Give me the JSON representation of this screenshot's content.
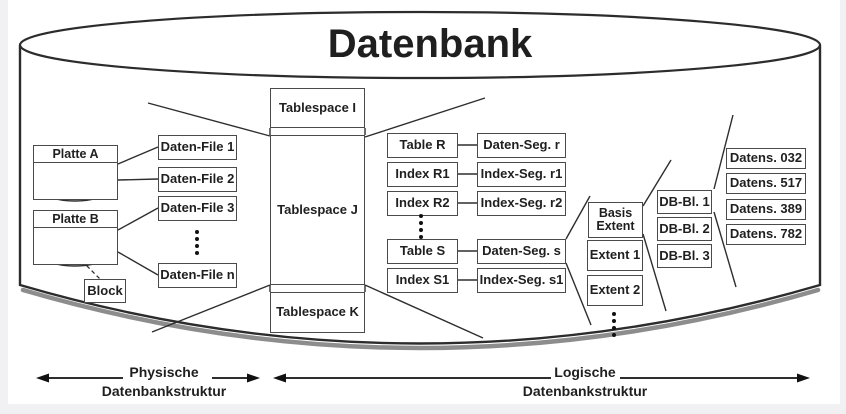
{
  "colors": {
    "ink": "#1f1f1f",
    "box_border": "#4a4a4a",
    "background": "#ffffff",
    "page": "#f1f1f4"
  },
  "title": "Datenbank",
  "physical": {
    "disks": [
      {
        "label": "Platte A"
      },
      {
        "label": "Platte B"
      }
    ],
    "block_label": "Block",
    "files": [
      "Daten-File 1",
      "Daten-File 2",
      "Daten-File 3",
      "Daten-File n"
    ]
  },
  "tablespaces": [
    "Tablespace I",
    "Tablespace J",
    "Tablespace K"
  ],
  "logical": {
    "tables": [
      "Table R",
      "Index R1",
      "Index R2",
      "Table S",
      "Index S1"
    ],
    "segments": [
      "Daten-Seg. r",
      "Index-Seg. r1",
      "Index-Seg. r2",
      "Daten-Seg. s",
      "Index-Seg. s1"
    ],
    "extents": [
      "Basis Extent",
      "Extent 1",
      "Extent 2"
    ],
    "db_blocks": [
      "DB-Bl. 1",
      "DB-Bl. 2",
      "DB-Bl. 3"
    ],
    "records": [
      "Datens. 032",
      "Datens. 517",
      "Datens. 389",
      "Datens. 782"
    ]
  },
  "legend": {
    "left_line1": "Physische",
    "left_line2": "Datenbankstruktur",
    "right_line1": "Logische",
    "right_line2": "Datenbankstruktur"
  }
}
